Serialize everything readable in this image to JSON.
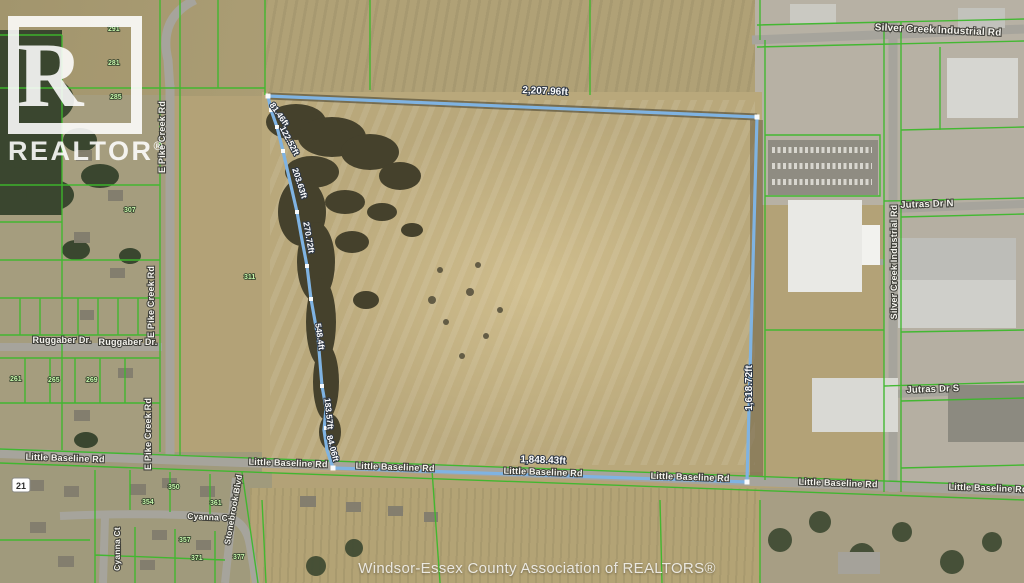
{
  "watermark": {
    "letter": "R",
    "wordmark": "REALTOR",
    "reg": "®"
  },
  "footer": {
    "credit": "Windsor-Essex County Association of REALTORS®"
  },
  "boundary": {
    "line_color": "#7fb3e2",
    "labels": {
      "north": "2,207.96ft",
      "east": "1,618.72ft",
      "south": "1,848.43ft",
      "west1": "81.46ft",
      "west2": "122.52ft",
      "west3": "203.63ft",
      "west4": "270.72ft",
      "west5": "548.4ft",
      "west6": "183.57ft",
      "west7": "84.06ft"
    }
  },
  "roads": {
    "silver_creek": "Silver Creek Industrial Rd",
    "jutras_n": "Jutras Dr N",
    "jutras_s": "Jutras Dr S",
    "e_pike_creek": "E Pike Creek Rd",
    "ruggaber": "Ruggaber Dr.",
    "little_baseline": "Little Baseline Rd",
    "cyanna": "Cyanna Ct",
    "stonebrook": "Stonebrook Blvd",
    "shield": "21"
  },
  "parcels": {
    "line_color": "#3db82c",
    "numbers": [
      "291",
      "281",
      "285",
      "261",
      "265",
      "269",
      "350",
      "354",
      "361",
      "357",
      "371",
      "377",
      "311",
      "307"
    ]
  }
}
